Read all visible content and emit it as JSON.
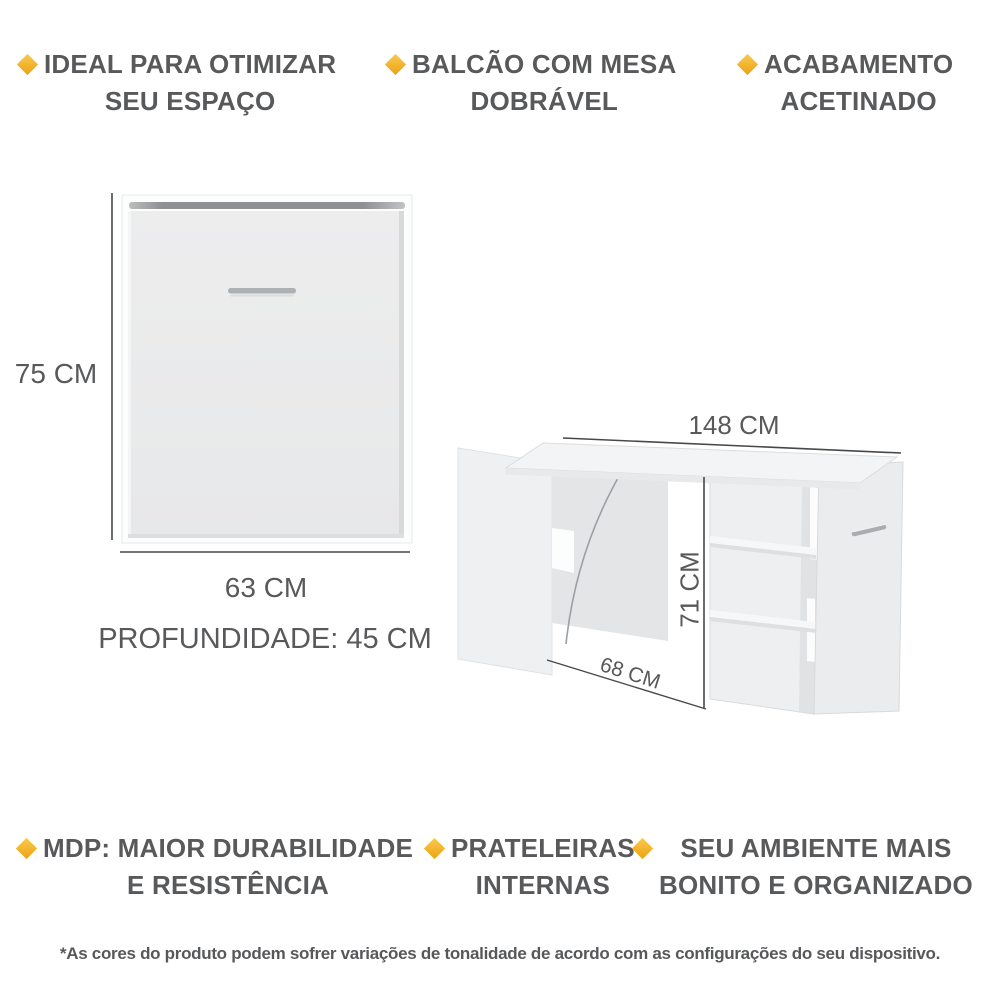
{
  "colors": {
    "accent_diamond": "#F2B42C",
    "text_gray": "#58595B",
    "dimension_line": "#47484A",
    "furniture_light": "#ECEDEE",
    "background": "#FFFFFF"
  },
  "features_top": [
    {
      "icon": "diamond-icon",
      "line1": "IDEAL PARA OTIMIZAR",
      "line2": "SEU ESPAÇO"
    },
    {
      "icon": "diamond-icon",
      "line1": "BALCÃO COM MESA",
      "line2": "DOBRÁVEL"
    },
    {
      "icon": "diamond-icon",
      "line1": "ACABAMENTO",
      "line2": "ACETINADO"
    }
  ],
  "features_bottom": [
    {
      "icon": "diamond-icon",
      "line1": "MDP: MAIOR DURABILIDADE",
      "line2": "E RESISTÊNCIA"
    },
    {
      "icon": "diamond-icon",
      "line1": "PRATELEIRAS",
      "line2": "INTERNAS"
    },
    {
      "icon": "diamond-icon",
      "line1": "SEU AMBIENTE MAIS",
      "line2": "BONITO E ORGANIZADO"
    }
  ],
  "cabinet_diagram": {
    "height_label": "75 CM",
    "width_label": "63 CM",
    "depth_label": "PROFUNDIDADE: 45 CM"
  },
  "desk_diagram": {
    "total_width_label": "148 CM",
    "height_label": "71 CM",
    "table_depth_label": "68 CM"
  },
  "disclaimer": "*As cores do produto podem sofrer variações de tonalidade de acordo com as configurações do seu dispositivo."
}
